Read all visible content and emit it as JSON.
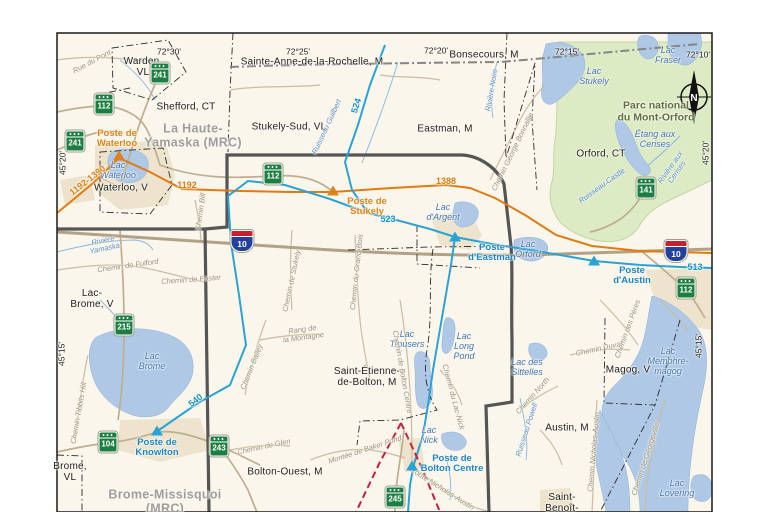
{
  "north_label": "N",
  "colors": {
    "background": "#faf6ec",
    "water": "#aec8e6",
    "park_green": "#dcebc4",
    "built_up": "#e9dcc2",
    "study_boundary": "#555555",
    "transmission_orange": "#e07b10",
    "transmission_blue": "#2ba3d2",
    "project_red": "#c41f3e",
    "road": "#c9bca0",
    "autoroute": "#b3a183"
  },
  "graticule_labels": [
    {
      "t": "72°30'",
      "x": 169,
      "y": 52
    },
    {
      "t": "72°25'",
      "x": 298,
      "y": 52
    },
    {
      "t": "72°20'",
      "x": 436,
      "y": 51
    },
    {
      "t": "72°15'",
      "x": 567,
      "y": 52
    },
    {
      "t": "72°10'",
      "x": 698,
      "y": 55
    },
    {
      "t": "45°20'",
      "x": 63,
      "y": 163,
      "r": -90
    },
    {
      "t": "45°15'",
      "x": 62,
      "y": 354,
      "r": -90
    },
    {
      "t": "45°20'",
      "x": 706,
      "y": 153,
      "r": -90
    },
    {
      "t": "45°15'",
      "x": 699,
      "y": 346,
      "r": -90
    }
  ],
  "municipality_labels": [
    {
      "t": "Warden,\nVL",
      "x": 143,
      "y": 67
    },
    {
      "t": "Shefford, CT",
      "x": 186,
      "y": 107
    },
    {
      "t": "Sainte-Anne-de-la-Rochelle, M",
      "x": 312,
      "y": 62
    },
    {
      "t": "Bonsecours, M",
      "x": 484,
      "y": 55
    },
    {
      "t": "Stukely-Sud, VL",
      "x": 289,
      "y": 127
    },
    {
      "t": "Eastman, M",
      "x": 445,
      "y": 129
    },
    {
      "t": "Orford, CT",
      "x": 601,
      "y": 154
    },
    {
      "t": "Waterloo, V",
      "x": 121,
      "y": 188
    },
    {
      "t": "Lac-\nBrome, V",
      "x": 92,
      "y": 299
    },
    {
      "t": "Brome,\nVL",
      "x": 70,
      "y": 472
    },
    {
      "t": "Bolton-Ouest, M",
      "x": 285,
      "y": 472
    },
    {
      "t": "Saint-Étienne-\nde-Bolton, M",
      "x": 367,
      "y": 377
    },
    {
      "t": "Austin, M",
      "x": 567,
      "y": 428
    },
    {
      "t": "Magog, V",
      "x": 628,
      "y": 370
    },
    {
      "t": "Saint-\nBenoît-",
      "x": 562,
      "y": 503
    }
  ],
  "mrc_labels": [
    {
      "t": "La Haute-\nYamaska (MRC)",
      "x": 193,
      "y": 136
    },
    {
      "t": "Brome-Missisquoi\n(MRC)",
      "x": 165,
      "y": 502
    }
  ],
  "park_labels": [
    {
      "t": "Parc national\ndu Mont-Orford",
      "x": 656,
      "y": 112
    }
  ],
  "lake_labels": [
    {
      "t": "Lac\nWaterloo",
      "x": 118,
      "y": 171
    },
    {
      "t": "Lac\nStukely",
      "x": 594,
      "y": 77
    },
    {
      "t": "Lac\nFraser",
      "x": 668,
      "y": 56
    },
    {
      "t": "Étang aux\nCerises",
      "x": 655,
      "y": 140
    },
    {
      "t": "Lac\nd'Argent",
      "x": 443,
      "y": 213
    },
    {
      "t": "Lac\nOrford",
      "x": 528,
      "y": 250
    },
    {
      "t": "Lac\nBrome",
      "x": 152,
      "y": 362
    },
    {
      "t": "Lac\nTrousers",
      "x": 407,
      "y": 340
    },
    {
      "t": "Lac\nLong\nPond",
      "x": 464,
      "y": 347
    },
    {
      "t": "Lac\nNick",
      "x": 429,
      "y": 436
    },
    {
      "t": "Lac des\nSittelles",
      "x": 527,
      "y": 368
    },
    {
      "t": "Lac\nMemphré-\nmagog",
      "x": 668,
      "y": 362
    },
    {
      "t": "Lac\nLovering",
      "x": 677,
      "y": 489
    }
  ],
  "stream_labels": [
    {
      "t": "Ruisseau Guilbert",
      "x": 327,
      "y": 127,
      "r": -65
    },
    {
      "t": "Rivière Noire",
      "x": 492,
      "y": 90,
      "r": -80
    },
    {
      "t": "Rivière\nYamaska",
      "x": 104,
      "y": 245,
      "r": -12
    },
    {
      "t": "Ruisseau Castle",
      "x": 602,
      "y": 186,
      "r": -36
    },
    {
      "t": "Rivière aux\nCerises",
      "x": 674,
      "y": 170,
      "r": -55
    },
    {
      "t": "Ruisseau Powell",
      "x": 527,
      "y": 430,
      "r": -72
    }
  ],
  "road_labels": [
    {
      "t": "Rue du Pont",
      "x": 92,
      "y": 62,
      "r": -28
    },
    {
      "t": "Chemin Bill",
      "x": 201,
      "y": 212,
      "r": -82
    },
    {
      "t": "Chemin de Stukely",
      "x": 292,
      "y": 281,
      "r": -78
    },
    {
      "t": "Chemin du Grand-Bois",
      "x": 357,
      "y": 272,
      "r": -84
    },
    {
      "t": "Chemin George Bonnallie",
      "x": 513,
      "y": 152,
      "r": -64
    },
    {
      "t": "Chemin de Fulford",
      "x": 128,
      "y": 266,
      "r": -8
    },
    {
      "t": "Chemin de Foster",
      "x": 191,
      "y": 280,
      "r": -4
    },
    {
      "t": "Chemin Tibbits Hill",
      "x": 79,
      "y": 413,
      "r": -80
    },
    {
      "t": "Rang de\nla Montagne",
      "x": 303,
      "y": 334,
      "r": -8
    },
    {
      "t": "Chemin Bailey",
      "x": 252,
      "y": 367,
      "r": -68
    },
    {
      "t": "Chemin de Glen",
      "x": 264,
      "y": 447,
      "r": -12
    },
    {
      "t": "Montée de Baker Pond",
      "x": 365,
      "y": 450,
      "r": -18
    },
    {
      "t": "Chemin de Bolton Centre",
      "x": 402,
      "y": 372,
      "r": 80
    },
    {
      "t": "Chemin du Lac-Nick",
      "x": 453,
      "y": 397,
      "r": 75
    },
    {
      "t": "Route Nicholas-Austin",
      "x": 442,
      "y": 489,
      "r": 32
    },
    {
      "t": "Chemin Nicholas-Austin",
      "x": 594,
      "y": 452,
      "r": -85
    },
    {
      "t": "Chemin Duval",
      "x": 599,
      "y": 349,
      "r": -12
    },
    {
      "t": "Chemin North",
      "x": 533,
      "y": 396,
      "r": -48
    },
    {
      "t": "Chemin de Georgeville",
      "x": 646,
      "y": 459,
      "r": -72
    },
    {
      "t": "Chemin des Pères",
      "x": 628,
      "y": 329,
      "r": -70
    }
  ],
  "line_labels": [
    {
      "t": "1192-1390",
      "x": 88,
      "y": 181,
      "r": -38,
      "c": "o"
    },
    {
      "t": "1192",
      "x": 187,
      "y": 186,
      "c": "o"
    },
    {
      "t": "1388",
      "x": 446,
      "y": 182,
      "c": "o"
    },
    {
      "t": "524",
      "x": 357,
      "y": 106,
      "r": -72,
      "c": "b"
    },
    {
      "t": "523",
      "x": 388,
      "y": 220,
      "c": "b"
    },
    {
      "t": "540",
      "x": 196,
      "y": 401,
      "r": -38,
      "c": "b"
    },
    {
      "t": "513",
      "x": 695,
      "y": 268,
      "c": "b"
    }
  ],
  "postes": [
    {
      "t": "Poste de\nWaterloo",
      "x": 117,
      "y": 139,
      "tx": 119,
      "ty": 156,
      "c": "o"
    },
    {
      "t": "Poste de\nStukely",
      "x": 367,
      "y": 207,
      "tx": 333,
      "ty": 191,
      "c": "o"
    },
    {
      "t": "Poste\nd'Eastman",
      "x": 492,
      "y": 253,
      "tx": 455,
      "ty": 237,
      "c": "b"
    },
    {
      "t": "Poste\nd'Austin",
      "x": 632,
      "y": 276,
      "tx": 594,
      "ty": 261,
      "c": "b"
    },
    {
      "t": "Poste de\nKnowlton",
      "x": 157,
      "y": 448,
      "tx": 157,
      "ty": 431,
      "c": "b"
    },
    {
      "t": "Poste de\nBolton Centre",
      "x": 452,
      "y": 464,
      "tx": 412,
      "ty": 466,
      "c": "b"
    }
  ],
  "shields_qc": [
    {
      "n": "241",
      "x": 160,
      "y": 73
    },
    {
      "n": "241",
      "x": 75,
      "y": 141
    },
    {
      "n": "112",
      "x": 104,
      "y": 104
    },
    {
      "n": "112",
      "x": 273,
      "y": 174
    },
    {
      "n": "112",
      "x": 686,
      "y": 288
    },
    {
      "n": "215",
      "x": 124,
      "y": 325
    },
    {
      "n": "104",
      "x": 108,
      "y": 442
    },
    {
      "n": "243",
      "x": 219,
      "y": 446
    },
    {
      "n": "245",
      "x": 395,
      "y": 497
    },
    {
      "n": "141",
      "x": 646,
      "y": 188
    }
  ],
  "shields_aut": [
    {
      "n": "10",
      "x": 242,
      "y": 241
    },
    {
      "n": "10",
      "x": 676,
      "y": 251
    }
  ]
}
